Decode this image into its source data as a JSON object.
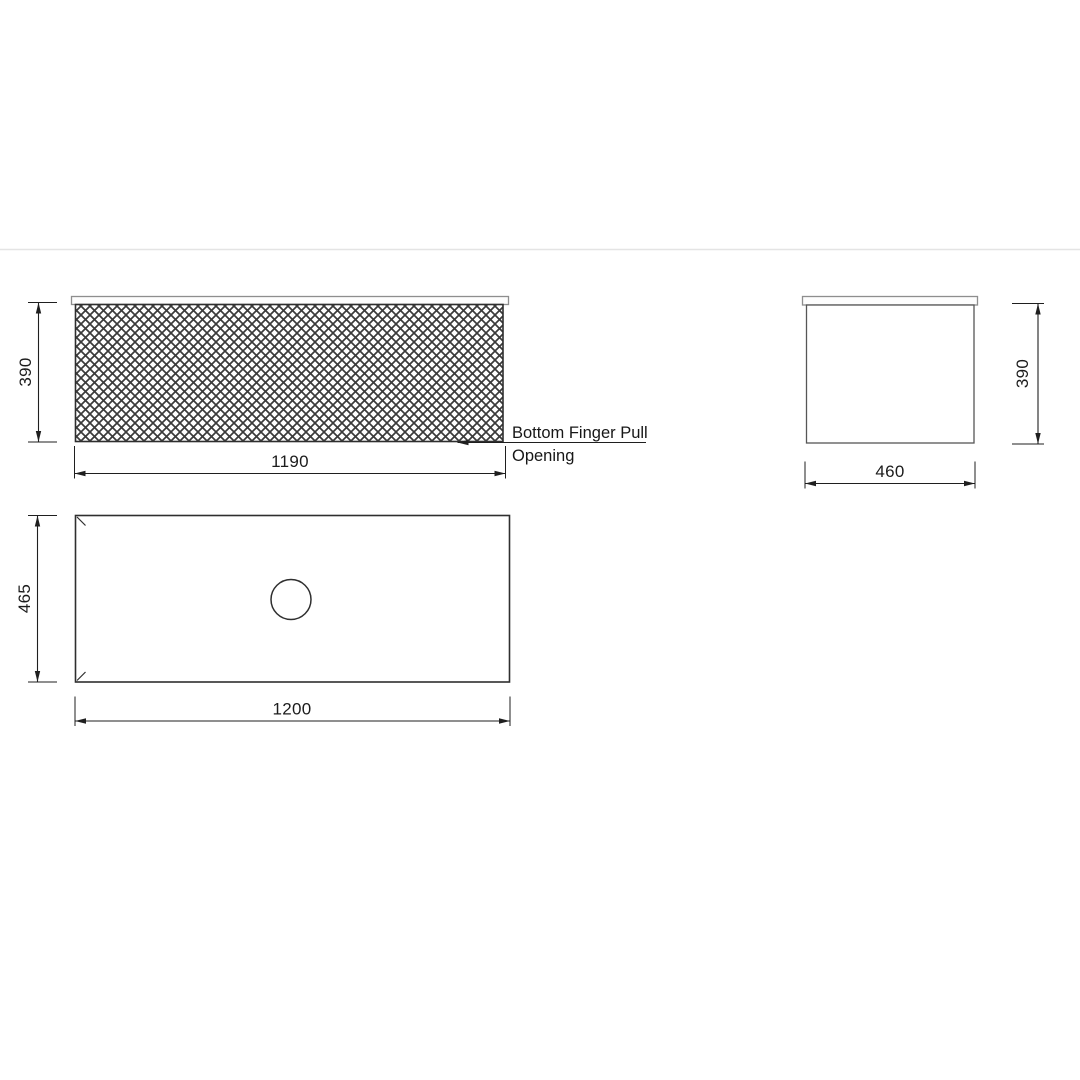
{
  "page": {
    "kind": "product technical drawing",
    "background": "#ffffff"
  },
  "colors": {
    "line": "#2f2f2f",
    "dim": "#1f1f1f",
    "counter": "#8e8e8e",
    "hatch": "#3b3b3b",
    "separator": "#e4e4e4"
  },
  "views": {
    "front": {
      "height_dim": "390",
      "width_dim": "1190",
      "callout_line1": "Bottom Finger Pull",
      "callout_line2": "Opening"
    },
    "side": {
      "height_dim": "390",
      "width_dim": "460"
    },
    "plan": {
      "height_dim": "465",
      "width_dim": "1200"
    }
  }
}
